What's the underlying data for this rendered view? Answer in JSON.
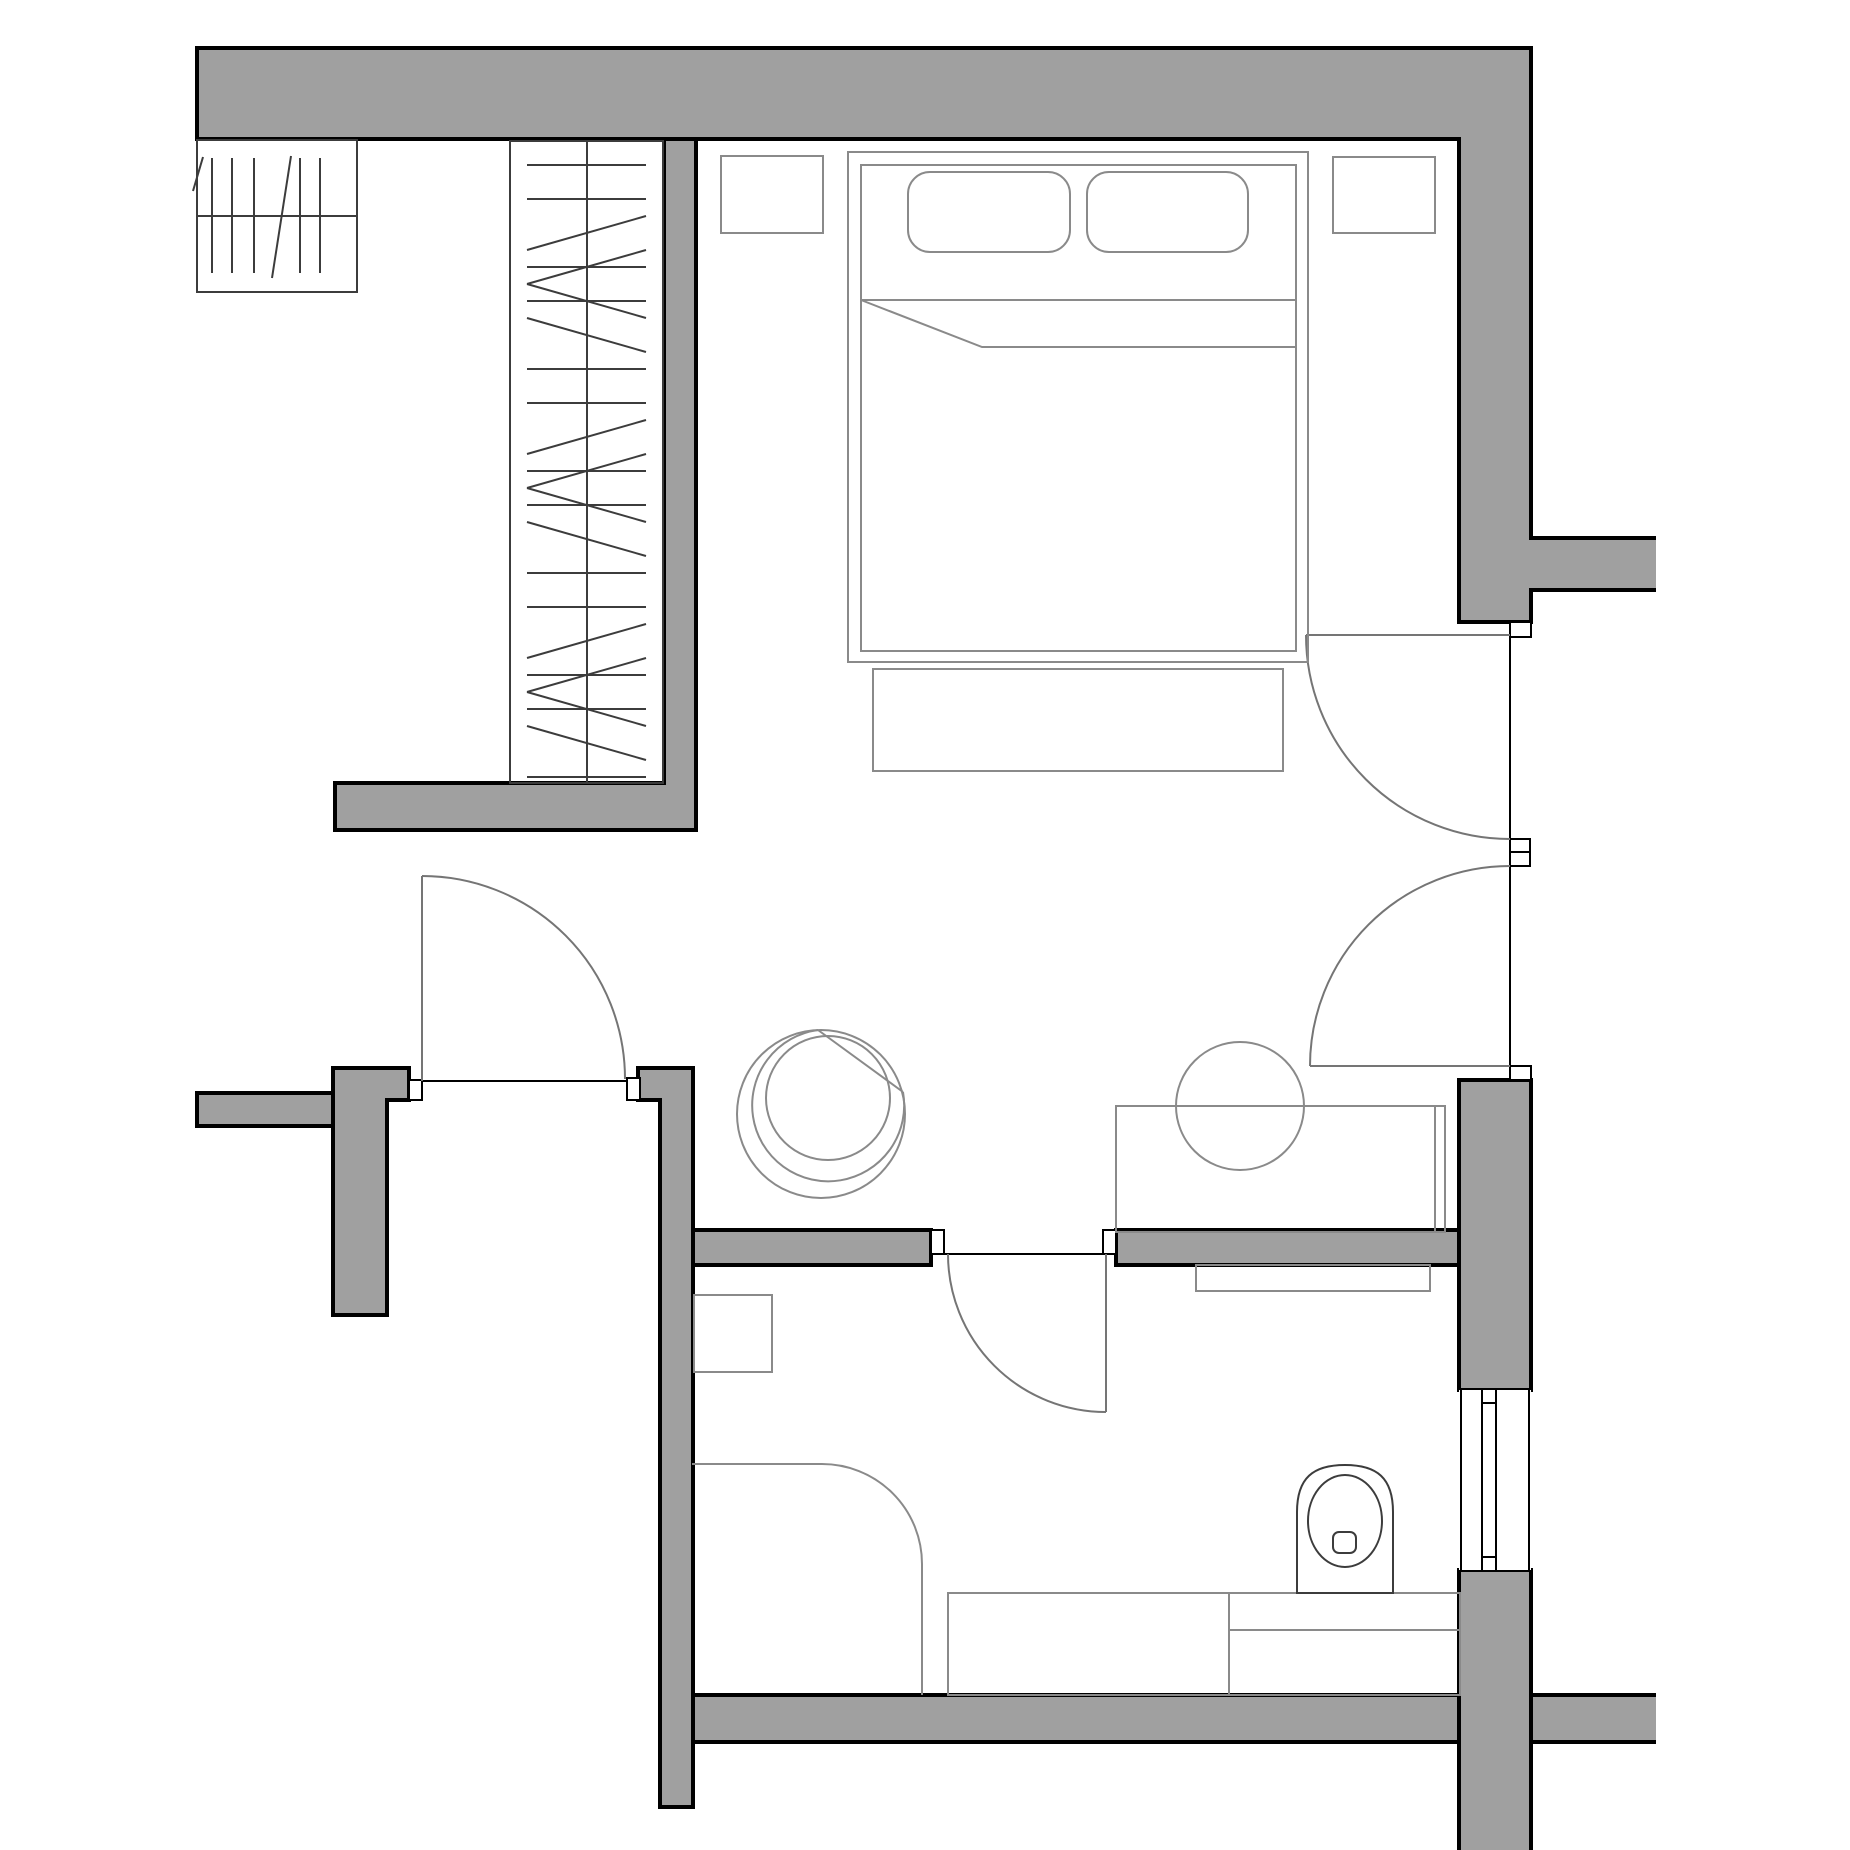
{
  "meta": {
    "type": "architectural-floor-plan",
    "canvas": {
      "width": 1850,
      "height": 1850
    },
    "visible_text": []
  },
  "colors": {
    "background": "#ffffff",
    "wall_fill": "#a0a0a0",
    "wall_outline": "#000000",
    "furniture_line": "#8a8a8a",
    "fixture_line": "#3c3c3c",
    "door_line": "#757575"
  },
  "elements": {
    "walls": [
      "top-exterior-wall",
      "right-wall-upper",
      "right-wall-protrusion",
      "wardrobe-side-wall-L",
      "entry-left-wall-stub",
      "entry-t-column",
      "bathroom-left-wall",
      "room-divider-wall-left",
      "room-divider-wall-right",
      "right-wall-lower",
      "bottom-wall",
      "right-wall-bottom-column"
    ],
    "openings": [
      "entry-door",
      "bathroom-door",
      "corridor-double-door-upper",
      "corridor-double-door-lower",
      "bathroom-window"
    ],
    "furniture": [
      "staircase",
      "wardrobe-with-hangers",
      "double-bed",
      "pillow-left",
      "pillow-right",
      "mattress-sheet-fold",
      "nightstand-left",
      "nightstand-right",
      "bed-end-bench",
      "tub-chair",
      "round-sink",
      "vanity-counter",
      "bathroom-wall-shelf",
      "bathroom-wall-cabinet",
      "shower-enclosure",
      "bathroom-bench-left",
      "bathroom-bench-right",
      "toilet"
    ]
  }
}
